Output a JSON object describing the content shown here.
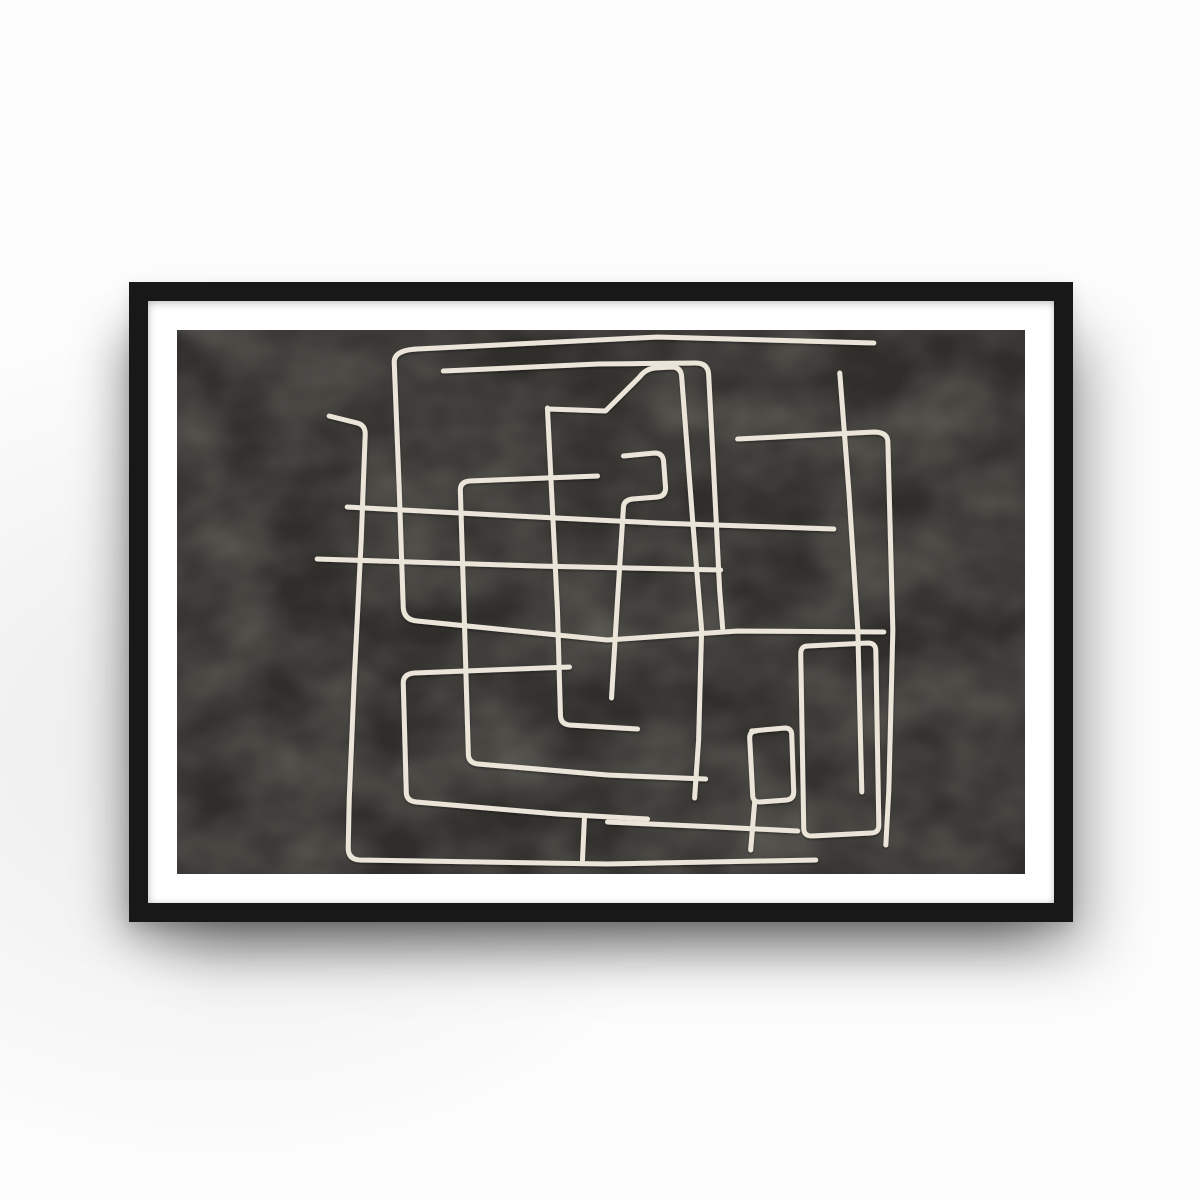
{
  "scene": {
    "description": "Photo of a framed abstract line-art poster hanging on a plain white wall with soft drop shadows below and to the sides of the frame",
    "wall_color": "#fcfcfc",
    "shadow_color": "rgba(0,0,0,0.28)"
  },
  "poster": {
    "frame_color": "#181818",
    "frame_style": "thin black frame",
    "mat_color": "#ffffff",
    "orientation": "landscape",
    "art_background_color": "#2b2926",
    "art_line_color": "#eae5d8",
    "art_style": "abstract single-line maze of overlapping rounded rectangles, off-white line on dark mottled charcoal"
  },
  "artwork": {
    "canvas": {
      "width": 847,
      "height": 544
    },
    "stroke_width": 5,
    "strokes": [
      "M152 86 L180 93 Q188 95 188 104 L184 210 177 350 172 470 171 518 Q171 529 182 530 L430 534 638 530",
      "M696 13 L480 7 240 19 Q216 20 217 33 L222 160 226 278 Q227 290 240 291 L430 310 560 301 706 302",
      "M266 41 L420 34 518 33 Q530 33 531 44 L536 140 542 260 545 298",
      "M420 146 L292 151 Q283 152 283 160 L287 290 291 424 Q291 433 301 434 L430 445 528 449",
      "M446 126 L477 123 Q485 123 486 131 L488 158 Q488 166 480 167 L455 169 Q447 170 446 176 L440 270 434 368",
      "M170 177 L320 185 480 193 656 199",
      "M140 229 L360 236 543 240",
      "M392 337 L237 343 Q226 344 226 353 L229 462 Q229 471 239 472 L380 484 470 489",
      "M662 43 L671 160 680 300 684 462",
      "M560 109 L696 102 Q709 102 710 111 L715 300 711 460 708 515",
      "M630 316 L690 313 Q698 313 698 321 L701 495 Q701 503 693 503 L634 506 Q626 506 626 498 L623 324 Q623 316 630 316",
      "M430 492 L540 497 620 501",
      "M574 401 L607 398 Q614 398 614 405 L616 462 Q616 469 609 470 L582 472 Q575 472 575 465 L572 408 Q572 401 579 401",
      "M577 472 L573 520",
      "M370 78 L380 280 383 385 Q383 394 392 395 L460 399",
      "M371 79 L428 81 462 47 Q468 39 477 38 L494 37 Q503 37 504 46 L515 190 524 300 521 410 517 468",
      "M407 487 L405 530"
    ]
  }
}
